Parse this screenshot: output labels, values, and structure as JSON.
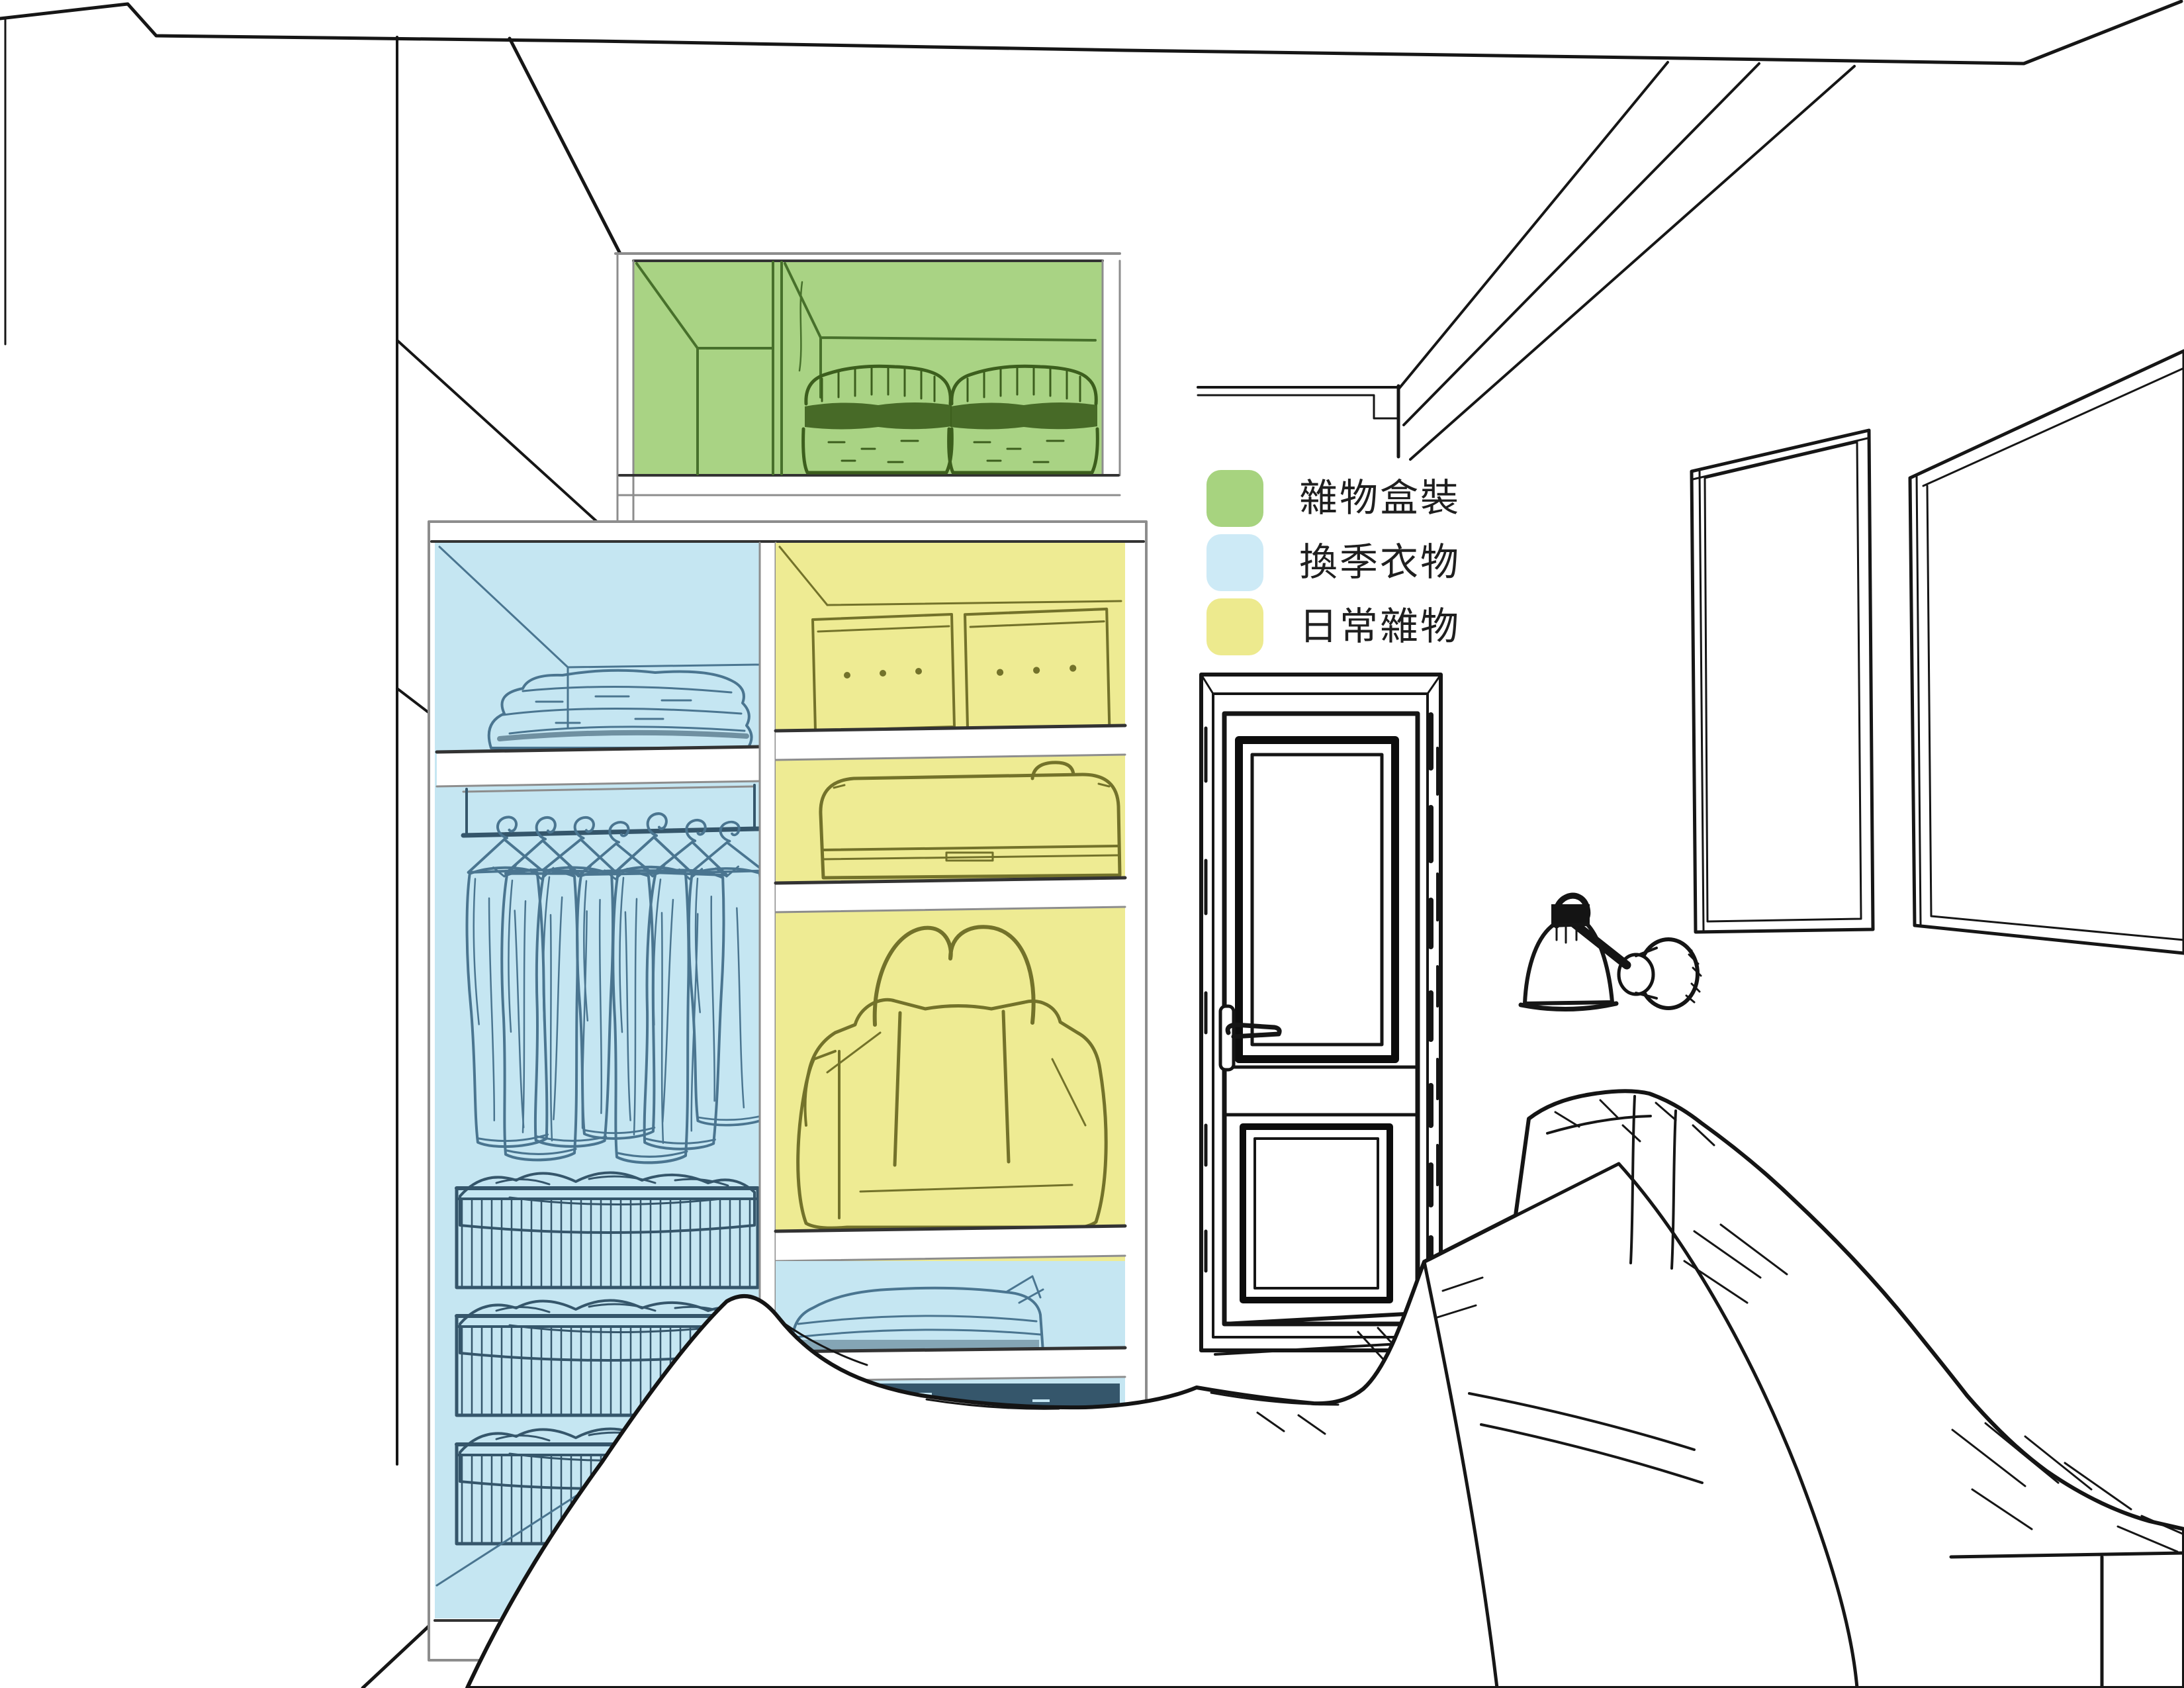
{
  "legend": {
    "items": [
      {
        "label": "雜物盒裝",
        "color": "#a7d37f",
        "zone": "closet-top-cabinet"
      },
      {
        "label": "換季衣物",
        "color": "#cdeaf6",
        "zone": "closet-left-column"
      },
      {
        "label": "日常雜物",
        "color": "#edea8e",
        "zone": "closet-right-column"
      }
    ]
  },
  "zones": {
    "green_fill": "#a9d384",
    "blue_fill": "#c5e6f2",
    "yellow_fill": "#eeeb93",
    "paper": "#ffffff"
  }
}
